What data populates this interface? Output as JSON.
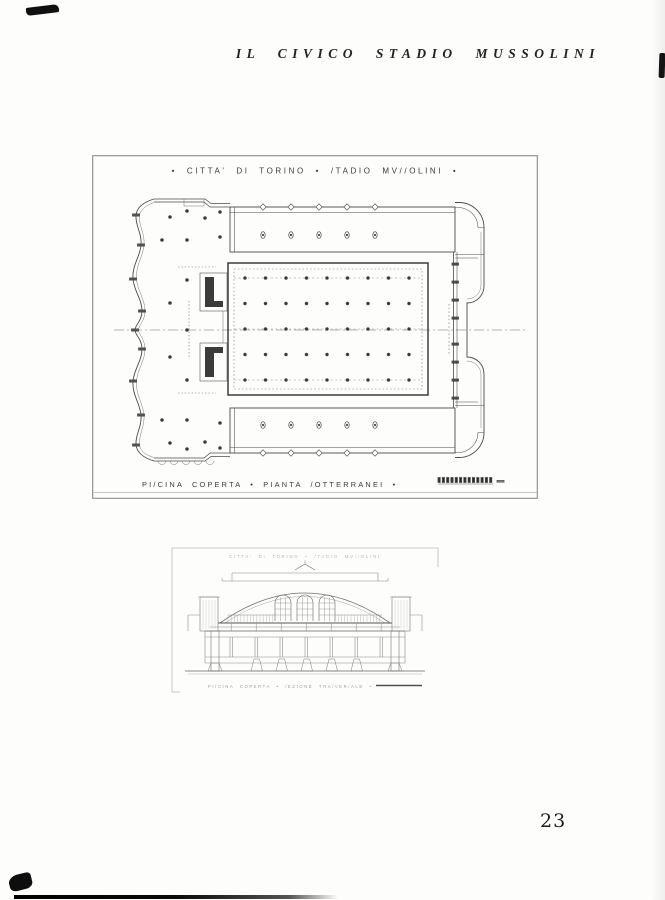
{
  "colors": {
    "paper": "#fdfdfc",
    "ink": "#2f2f2f",
    "frame_grey": "#8a8a8a"
  },
  "page": {
    "running_header": "IL CIVICO STADIO MUSSOLINI",
    "page_number": "23"
  },
  "plan_drawing": {
    "title": "•  CITTA'  DI  TORINO  •  /TADIO  MV//OLINI  •",
    "caption": "PI/CINA  COPERTA  •  PIANTA  /OTTERRANEI  •"
  },
  "section_drawing": {
    "title": "CITTA'  DI  TORINO  •  /TADIO  MV//OLINI",
    "caption": "PI/CINA  COPERTA  •  /EZIONE  TRA/VER/ALE  •"
  }
}
